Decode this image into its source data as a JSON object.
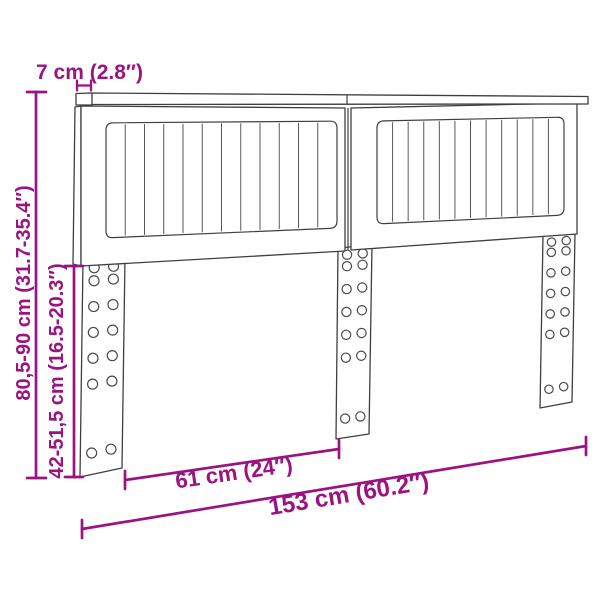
{
  "diagram": {
    "kind": "furniture-dimension-diagram",
    "product": "slatted headboard with three mounting legs",
    "style": {
      "accent_color": "#9b1380",
      "drawing_line_color": "#3f3f3f",
      "background_color": "#ffffff"
    },
    "dimensions": {
      "rail_thickness": {
        "label": "7 cm (2.8″)"
      },
      "total_height": {
        "label": "80,5-90 cm (31.7-35.4″)"
      },
      "leg_height": {
        "label": "42-51,5 cm (16.5-20.3″)"
      },
      "leg_spacing": {
        "label": "61 cm (24″)"
      },
      "total_width": {
        "label": "153 cm (60.2″)"
      }
    },
    "structure": {
      "panels": [
        {
          "name": "left-panel",
          "slats": 12
        },
        {
          "name": "right-panel",
          "slats": 12
        }
      ],
      "legs": [
        {
          "name": "left-leg",
          "hole_columns": 2,
          "hole_rows": 7
        },
        {
          "name": "center-leg",
          "hole_columns": 2,
          "hole_rows": 7
        },
        {
          "name": "right-leg",
          "hole_columns": 2,
          "hole_rows": 7
        }
      ]
    }
  }
}
